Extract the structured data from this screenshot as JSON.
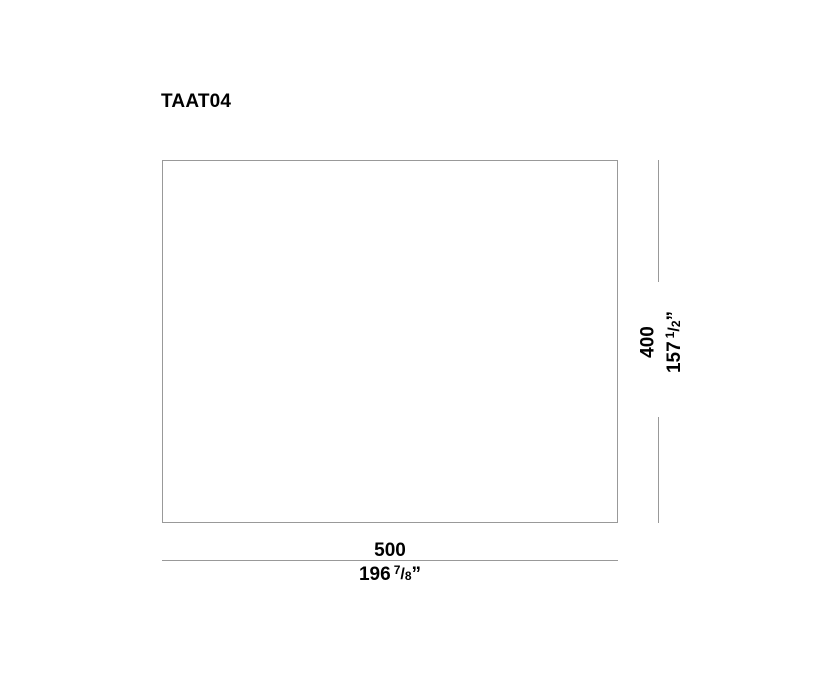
{
  "title": "TAAT04",
  "drawing": {
    "line_color": "#999999",
    "text_color": "#000000",
    "width_dim": {
      "mm": "500",
      "inches_whole": "196",
      "frac_numerator": "7",
      "frac_slash": "/",
      "frac_denominator": "8",
      "unit_mark": "”"
    },
    "height_dim": {
      "mm": "400",
      "inches_whole": "157",
      "frac_numerator": "1",
      "frac_slash": "/",
      "frac_denominator": "2",
      "unit_mark": "”"
    }
  }
}
